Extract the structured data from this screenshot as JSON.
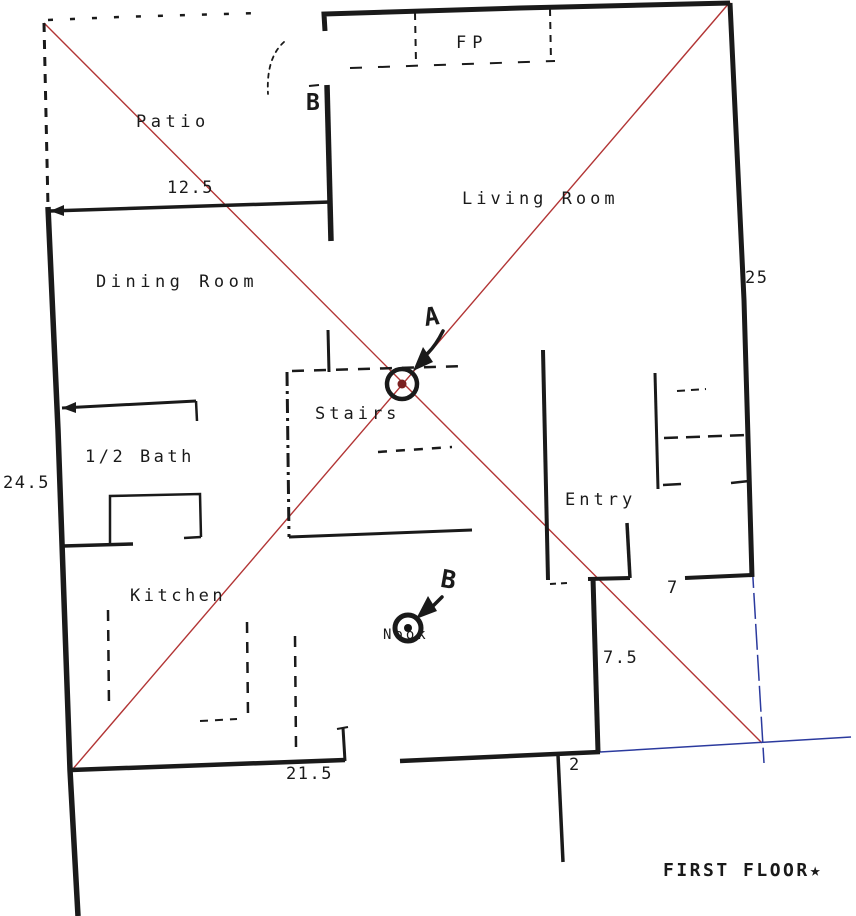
{
  "plan": {
    "title": "FIRST FLOOR★",
    "rooms": {
      "patio": "Patio",
      "living_room": "Living Room",
      "dining_room": "Dining Room",
      "stairs": "Stairs",
      "half_bath": "1/2 Bath",
      "entry": "Entry",
      "kitchen": "Kitchen",
      "nook": "Nook",
      "fireplace": "FP"
    },
    "dimensions": {
      "patio_width": "12.5",
      "right_wall": "25",
      "left_wall": "24.5",
      "entry_opening": "7",
      "lower_right_wall": "7.5",
      "bottom_offset": "2",
      "kitchen_wall": "21.5"
    },
    "markers": {
      "a": "A",
      "b_wall": "B",
      "b_nook": "B"
    },
    "colors": {
      "wall": "#1a1a1a",
      "red": "#b23535",
      "blue": "#2b3a9e",
      "dot_a": "#7a2020",
      "dot_b": "#141414"
    }
  }
}
